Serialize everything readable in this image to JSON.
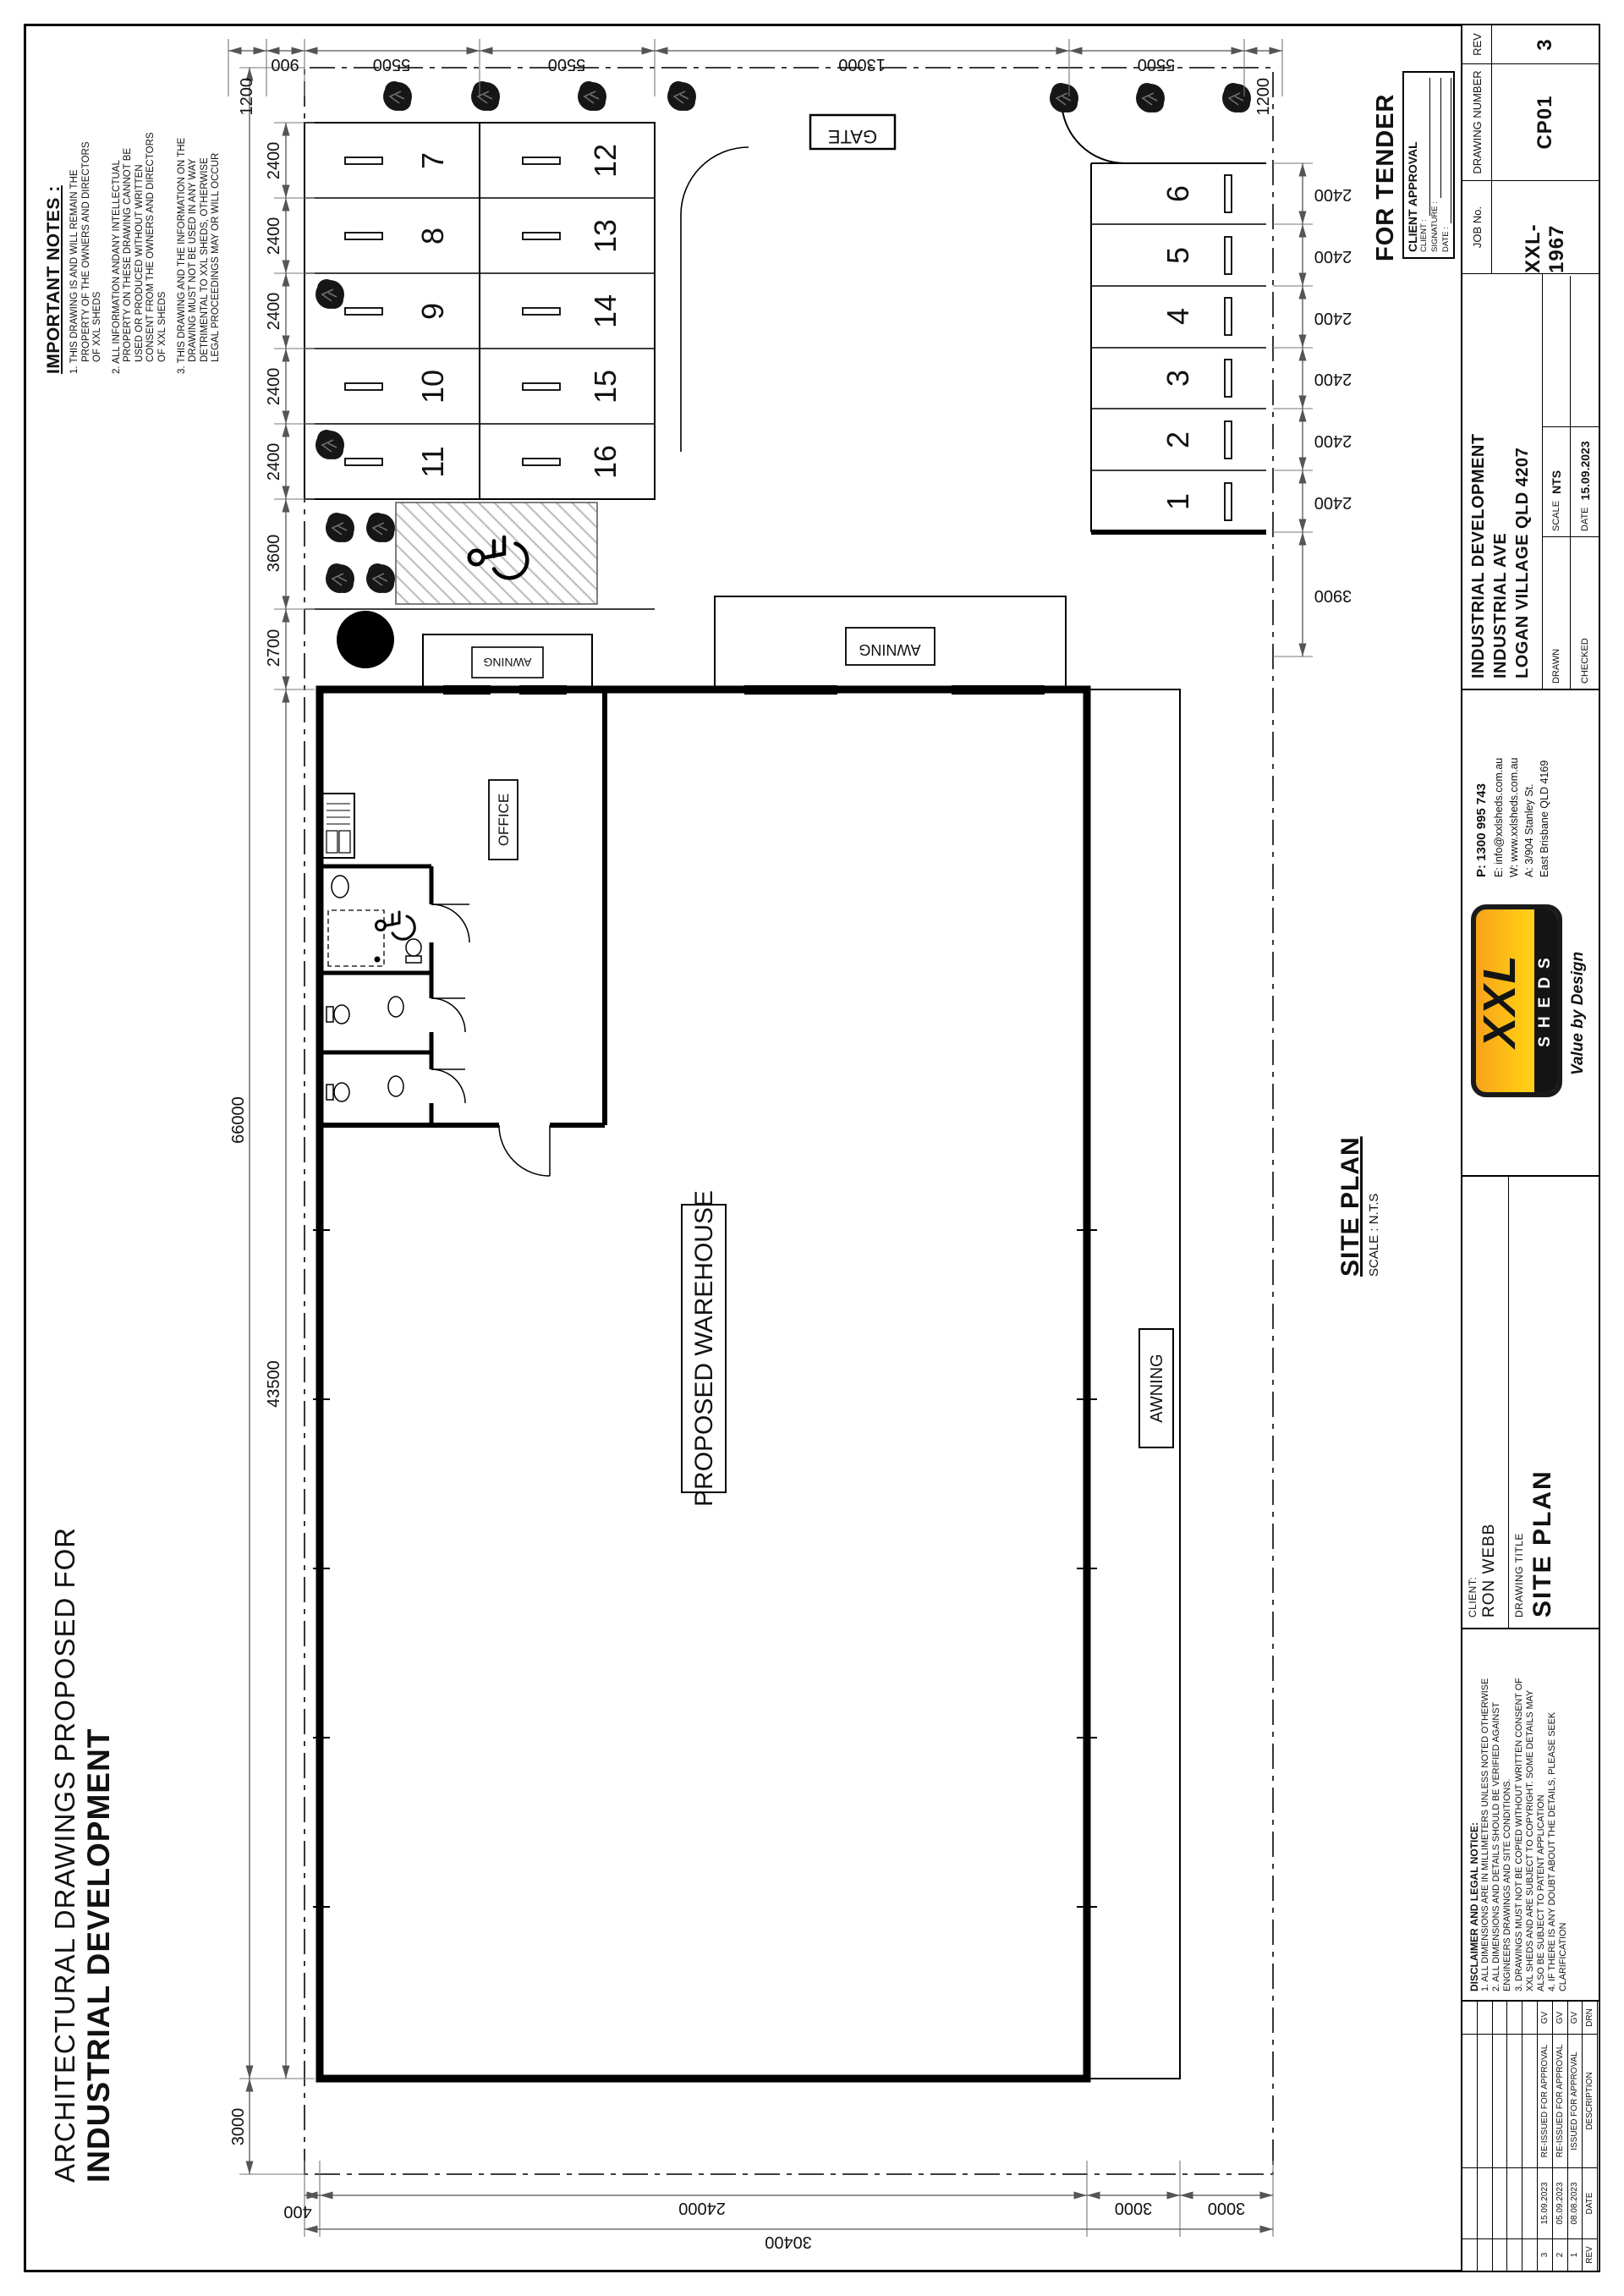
{
  "sheet": {
    "title_line1": "ARCHITECTURAL DRAWINGS PROPOSED FOR",
    "title_line2": "INDUSTRIAL DEVELOPMENT"
  },
  "important_notes": {
    "heading": "IMPORTANT NOTES :",
    "note1": "1. THIS DRAWING IS AND WILL REMAIN THE\nPROPERTY OF THE OWNERS AND DIRECTORS\nOF XXL SHEDS",
    "note2": "2. ALL INFORMATION ANDANY INTELLECTUAL\nPROPERTY ON THESE DRAWING CANNOT BE\nUSED OR PRODUCED WITHOUT WRITTEN\nCONSENT FROM THE OWNERS AND DIRECTORS\nOF XXL SHEDS",
    "note3": "3. THIS DRAWING AND THE INFORMATION ON THE\nDRAWING MUST NOT BE USED IN ANY WAY\nDETRIMENTAL TO XXL SHEDS, OTHERWISE\nLEGAL PROCEEDINGS MAY OR WILL OCCUR"
  },
  "plan": {
    "warehouse_label": "PROPOSED WAREHOUSE",
    "office_label": "OFFICE",
    "awning_label": "AWNING",
    "gate_label": "GATE",
    "caption_title": "SITE PLAN",
    "caption_scale": "SCALE : N.T.S",
    "bays": {
      "row_a": [
        "7",
        "8",
        "9",
        "10",
        "11"
      ],
      "row_b": [
        "12",
        "13",
        "14",
        "15",
        "16"
      ],
      "row_c": [
        "1",
        "2",
        "3",
        "4",
        "5",
        "6"
      ]
    },
    "dims": {
      "top_outer": [
        "3000",
        "66000"
      ],
      "top_inner": [
        "43500",
        "2700",
        "3600",
        "2400",
        "2400",
        "2400",
        "2400",
        "2400"
      ],
      "right": [
        "1200",
        "900",
        "5500",
        "5500",
        "13000",
        "5500",
        "1200"
      ],
      "left_inner": [
        "400",
        "24000",
        "3000",
        "3000"
      ],
      "left_outer": "30400",
      "bottom": [
        "3900",
        "2400",
        "2400",
        "2400",
        "2400",
        "2400",
        "2400"
      ]
    }
  },
  "approval": {
    "stamp": "FOR TENDER",
    "box_title": "CLIENT APPROVAL",
    "field_client": "CLIENT :",
    "field_signature": "SIGNATURE :",
    "field_date": "DATE :"
  },
  "title_block": {
    "revisions": {
      "h_rev": "REV",
      "h_date": "DATE",
      "h_desc": "DESCRIPTION",
      "h_drn": "DRN",
      "rows": [
        {
          "rev": "3",
          "date": "15.09.2023",
          "description": "RE-ISSUED FOR APPROVAL",
          "drn": "GV"
        },
        {
          "rev": "2",
          "date": "05.09.2023",
          "description": "RE-ISSUED FOR APPROVAL",
          "drn": "GV"
        },
        {
          "rev": "1",
          "date": "08.08.2023",
          "description": "ISSUED FOR APPROVAL",
          "drn": "GV"
        }
      ]
    },
    "disclaimer": {
      "heading": "DISCLAIMER AND LEGAL NOTICE:",
      "body": "1. ALL DIMENSIONS ARE IN MILLIMETERS UNLESS NOTED OTHERWISE\n2. ALL DIMENSIONS AND DETAILS SHOULD BE VERIFIED AGAINST\nENGINEERS DRAWINGS AND SITE CONDITIONS.\n3. DRAWINGS MUST NOT BE COPIED WITHOUT WRITTEN CONSENT OF\nXXL SHEDS AND ARE SUBJECT TO COPYRIGHT. SOME DETAILS MAY\nALSO BE SUBJECT TO PATENT APPLICATION\n4. IF THERE IS ANY DOUBT ABOUT THE DETAILS, PLEASE SEEK\nCLARIFICATION"
    },
    "client_label": "CLIENT:",
    "client_name": "RON WEBB",
    "drawing_title_label": "DRAWING TITLE",
    "drawing_title_value": "SITE PLAN",
    "contact": {
      "phone": "P: 1300 995 743",
      "email": "E: info@xxlsheds.com.au",
      "web": "W: www.xxlsheds.com.au",
      "addr1": "A: 3/904 Stanley St.",
      "addr2": "East Brisbane QLD 4169"
    },
    "logo": {
      "word1": "XXL",
      "word2": "SHEDS",
      "tagline": "Value by Design"
    },
    "project": {
      "line1": "INDUSTRIAL DEVELOPMENT",
      "line2": "INDUSTRIAL AVE",
      "line3": "LOGAN VILLAGE QLD 4207"
    },
    "fields": {
      "drawn_label": "DRAWN",
      "checked_label": "CHECKED",
      "scale_label": "SCALE",
      "scale_value": "NTS",
      "date_label": "DATE",
      "date_value": "15.09.2023",
      "job_label": "JOB No.",
      "job_value": "XXL-1967",
      "number_label": "DRAWING NUMBER",
      "number_value": "CP01",
      "rev_label": "REV",
      "rev_value": "3"
    },
    "colors": {
      "logo_orange": "#F7A21B",
      "logo_yellow": "#FFD93B"
    }
  }
}
